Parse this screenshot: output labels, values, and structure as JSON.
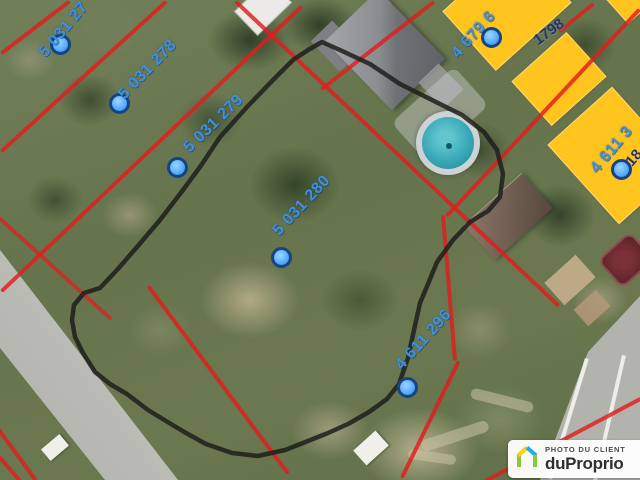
{
  "image": {
    "type": "aerial-cadastral-photo",
    "width": 640,
    "height": 480
  },
  "cadastre": {
    "lot_labels": [
      {
        "label": "5 031 27",
        "truncated": true
      },
      {
        "label": "5 031 278",
        "truncated": false
      },
      {
        "label": "5 031 279",
        "truncated": false
      },
      {
        "label": "5 031 280",
        "truncated": false
      },
      {
        "label": "4 611 296",
        "truncated": false
      },
      {
        "label": "4 679 6",
        "truncated": true
      },
      {
        "label": "4 611 3",
        "truncated": true
      }
    ],
    "address_labels": [
      {
        "label": "1798"
      },
      {
        "label": "18",
        "truncated": true
      }
    ],
    "marker_count": 7,
    "colors": {
      "cadastral_line": "#e11d1d",
      "lot_label_text": "#3f90dd",
      "address_text": "#22336f",
      "marker_fill": "#57aaff",
      "marker_ring": "#17447e",
      "building_footprint": "#ffc41e",
      "selection_outline": "#1e1e1c",
      "pool_water": "#3aa8b8"
    }
  },
  "watermark": {
    "line1": "PHOTO DU CLIENT",
    "line2": "duProprio",
    "icon": "duproprio-house-icon",
    "icon_colors": {
      "walls": "#8dc63f",
      "roof_left": "#ffd200",
      "roof_right": "#28abe2"
    },
    "background": "#ffffff",
    "text_color": "#2f2f2f"
  }
}
